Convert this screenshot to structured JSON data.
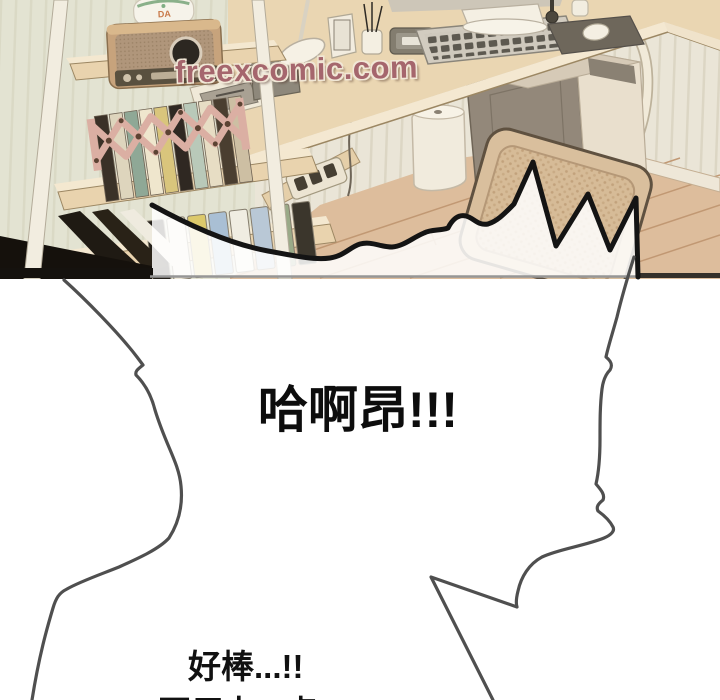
{
  "watermark": {
    "text": "freexcomic.com",
    "color": "#a5666d"
  },
  "speech": {
    "shout": "哈啊昂!!!",
    "caption_line1": "好棒...!!",
    "caption_line2": "再用力...点!!"
  },
  "shelf_device": {
    "label": "DA"
  },
  "palette": {
    "wall": "#eae5d7",
    "wall_left_tint": "#d8dfc8",
    "desk_wood": "#ead6b2",
    "shelf_wood": "#e9d3ae",
    "floor_wood": "#ddbd9c",
    "rack_pink": "#dbafa3",
    "pc_side": "#93887a",
    "pc_front": "#e9dfcd",
    "chair_rattan": "#d6bb97",
    "bubble_fill": "#ffffff",
    "bubble_outline": "#141414",
    "figure_line": "#4f4f4f",
    "panel_border_gray": "#969696",
    "panel_border_black": "#15120e"
  }
}
